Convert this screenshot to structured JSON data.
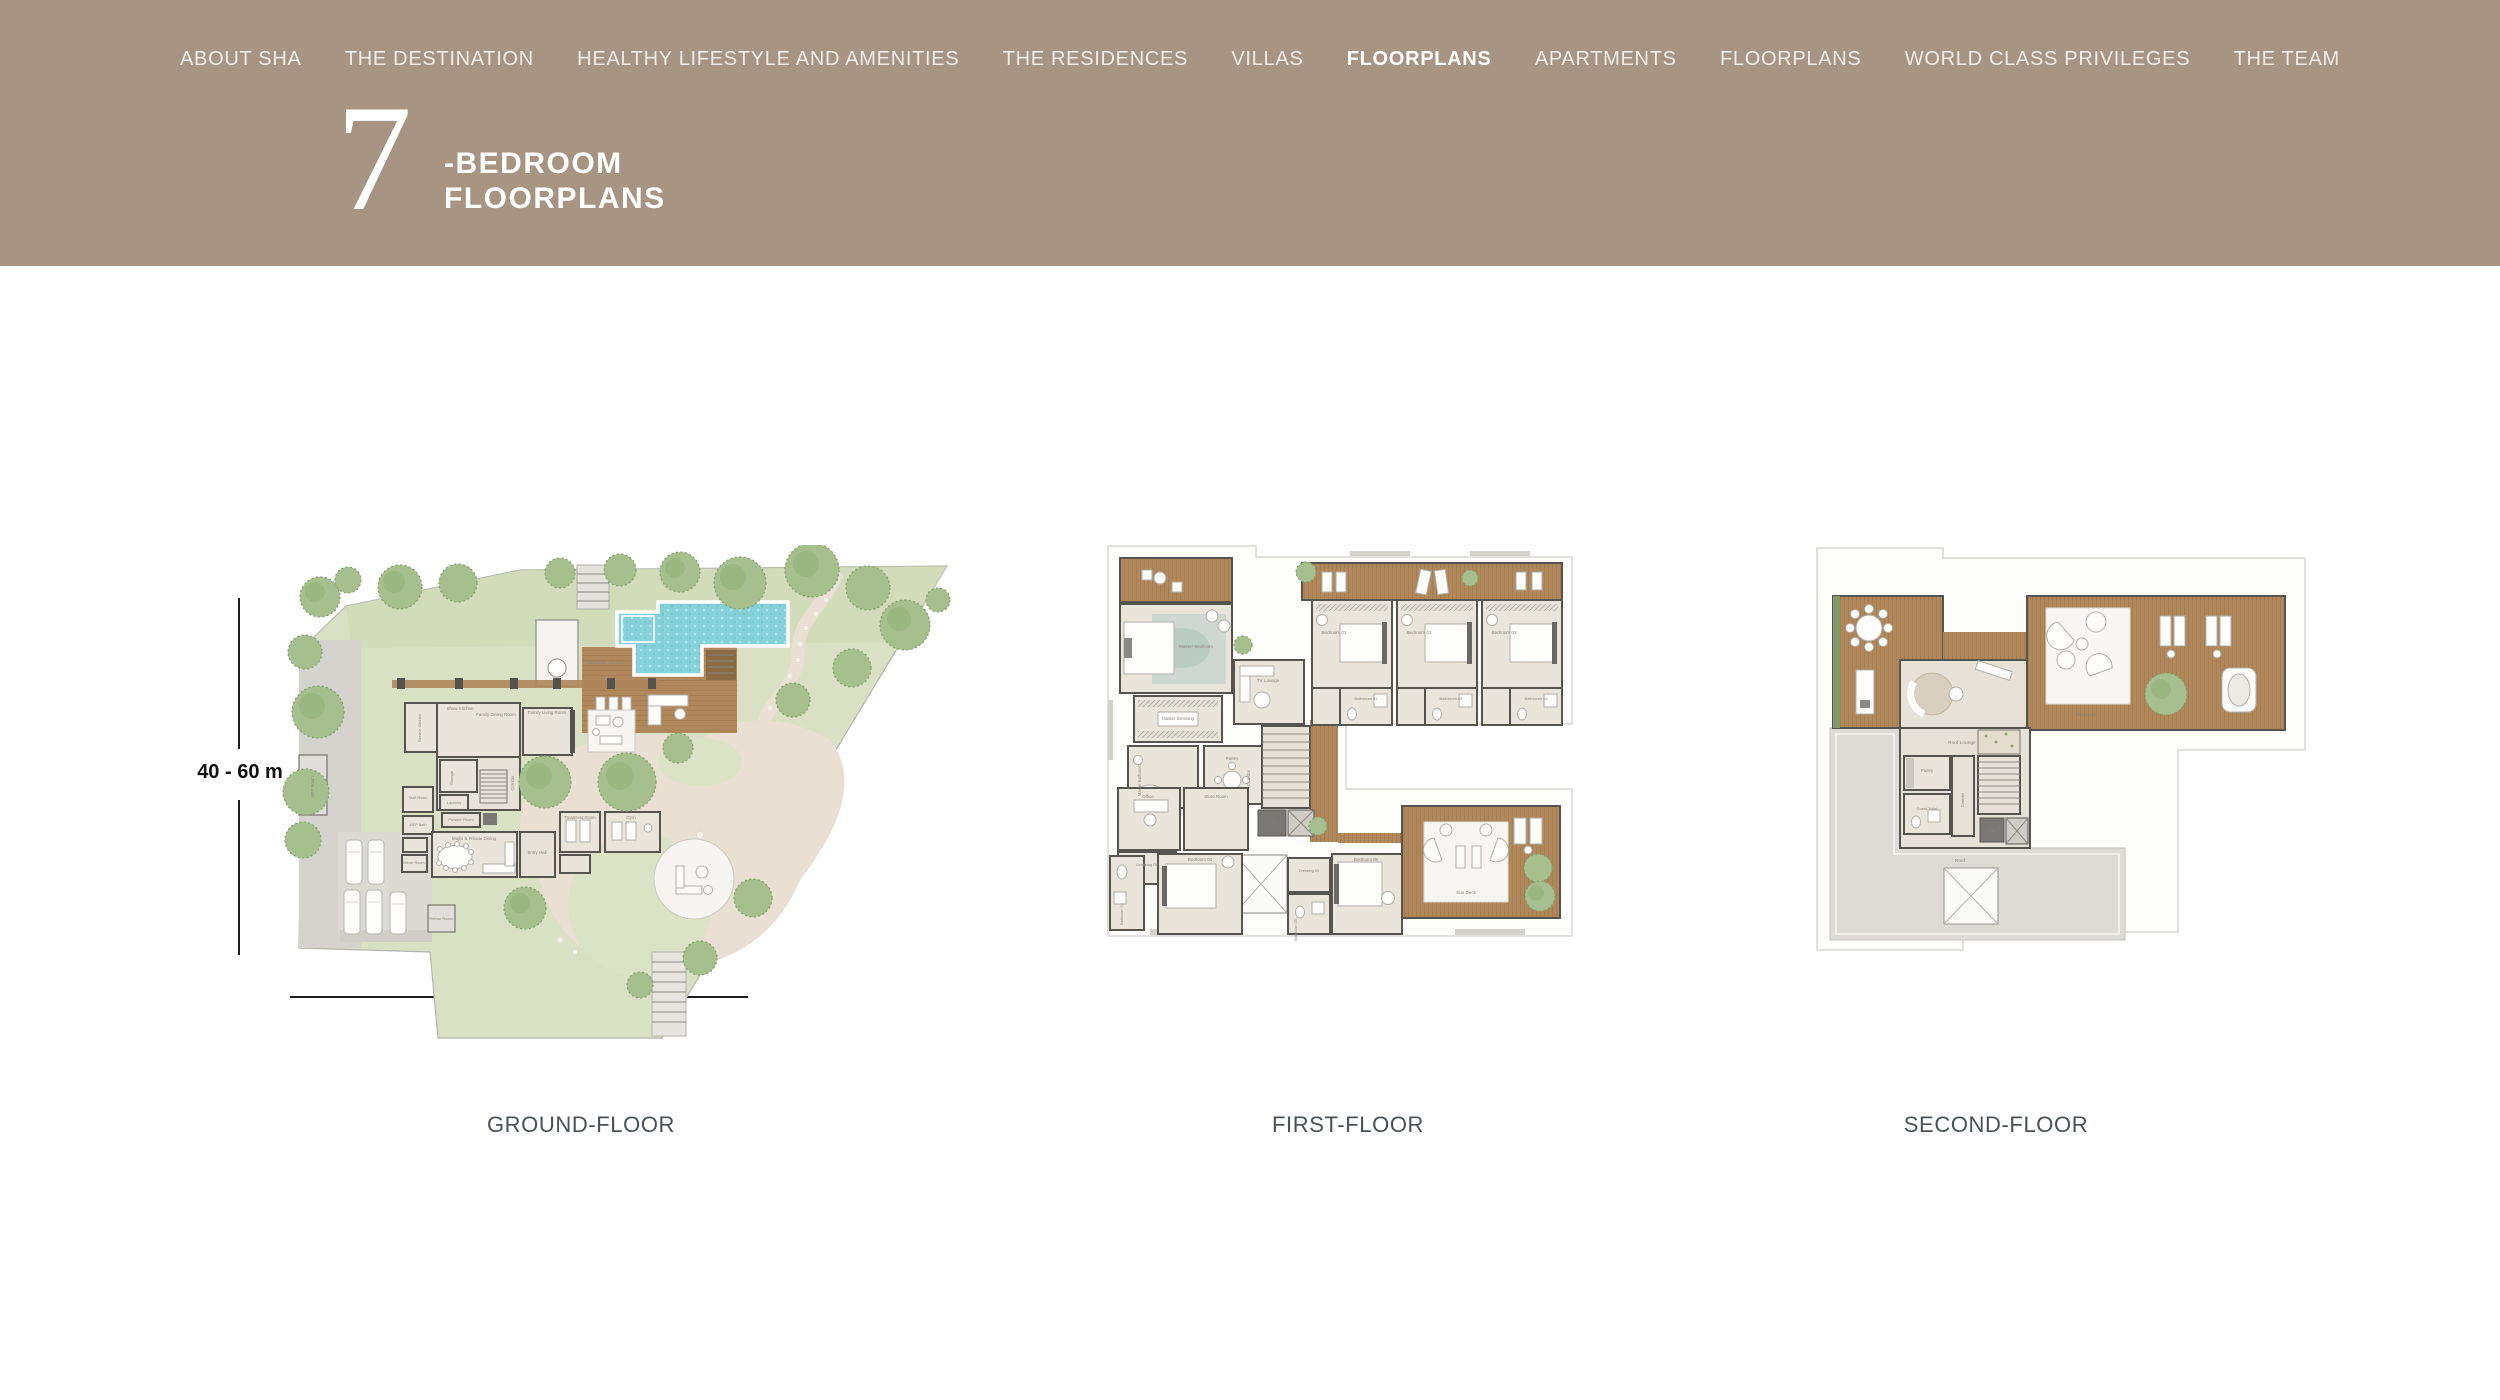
{
  "nav": {
    "items": [
      {
        "label": "ABOUT SHA",
        "active": false
      },
      {
        "label": "THE DESTINATION",
        "active": false
      },
      {
        "label": "HEALTHY LIFESTYLE AND AMENITIES",
        "active": false
      },
      {
        "label": "THE RESIDENCES",
        "active": false
      },
      {
        "label": "VILLAS",
        "active": false
      },
      {
        "label": "FLOORPLANS",
        "active": true
      },
      {
        "label": "APARTMENTS",
        "active": false
      },
      {
        "label": "FLOORPLANS",
        "active": false
      },
      {
        "label": "WORLD CLASS PRIVILEGES",
        "active": false
      },
      {
        "label": "THE TEAM",
        "active": false
      }
    ]
  },
  "hero": {
    "number": "7",
    "line1": "-BEDROOM",
    "line2": "FLOORPLANS"
  },
  "dimensions": {
    "vertical_label": "40 - 60 m",
    "horizontal_label": "41 - 85 m"
  },
  "floors": [
    {
      "label": "GROUND-FLOOR",
      "rooms": {
        "outdoor_terrace": "Outdoor Terrace",
        "show_kitchen": "Show Kitchen",
        "family_dining": "Family Dining Room",
        "family_living": "Family Living Room",
        "service_kitchen": "Service Kitchen",
        "corridor": "Corridor",
        "storage": "Storage",
        "laundry": "Laundry",
        "powder_room": "Powder Room",
        "staff_room": "Staff Room",
        "mep_bath": "MEP Bath",
        "driver_room": "Driver Room",
        "majlis": "Majlis & Private Dining",
        "entry_hall": "Entry Hall",
        "treatment_room": "Treatment Room",
        "gym": "Gym",
        "mep_room": "MEP Room",
        "refuse_room": "Refuse Room",
        "lift": "Lift"
      }
    },
    {
      "label": "FIRST-FLOOR",
      "rooms": {
        "master_bedroom": "Master Bedroom",
        "master_dressing": "Master Dressing",
        "master_bathroom": "Master Bathroom",
        "tv_lounge": "TV Lounge",
        "pantry": "Pantry",
        "corridor": "Corridor",
        "bedroom_01": "Bedroom 01",
        "bathroom_01": "Bathroom 01",
        "bedroom_02": "Bedroom 02",
        "bathroom_02": "Bathroom 02",
        "bedroom_03": "Bedroom 03",
        "bathroom_03": "Bathroom 03",
        "office": "Office",
        "store_room": "Store Room",
        "lift": "Lift",
        "dressing_04": "Dressing 04",
        "bedroom_04": "Bedroom 04",
        "bathroom_04": "Bathroom 04",
        "dressing_05": "Dressing 05",
        "bathroom_05": "Bathroom 05",
        "bedroom_05": "Bedroom 05",
        "sun_deck": "Sun Deck"
      }
    },
    {
      "label": "SECOND-FLOOR",
      "rooms": {
        "roof_lounge": "Roof Lounge",
        "pantry": "Pantry",
        "guest_toilet": "Guest Toilet",
        "corridor": "Corridor",
        "lift": "Lift",
        "roof": "Roof",
        "sun_deck": "Sun Deck"
      }
    }
  ],
  "colors": {
    "header_bg": "#a79482",
    "wood_deck": "#b0885c",
    "pool_water": "#86d1d8",
    "lawn": "#d9e0c4",
    "tree": "#a7bf8e",
    "wall": "#56544e",
    "floor_label_text": "#4b5058"
  }
}
